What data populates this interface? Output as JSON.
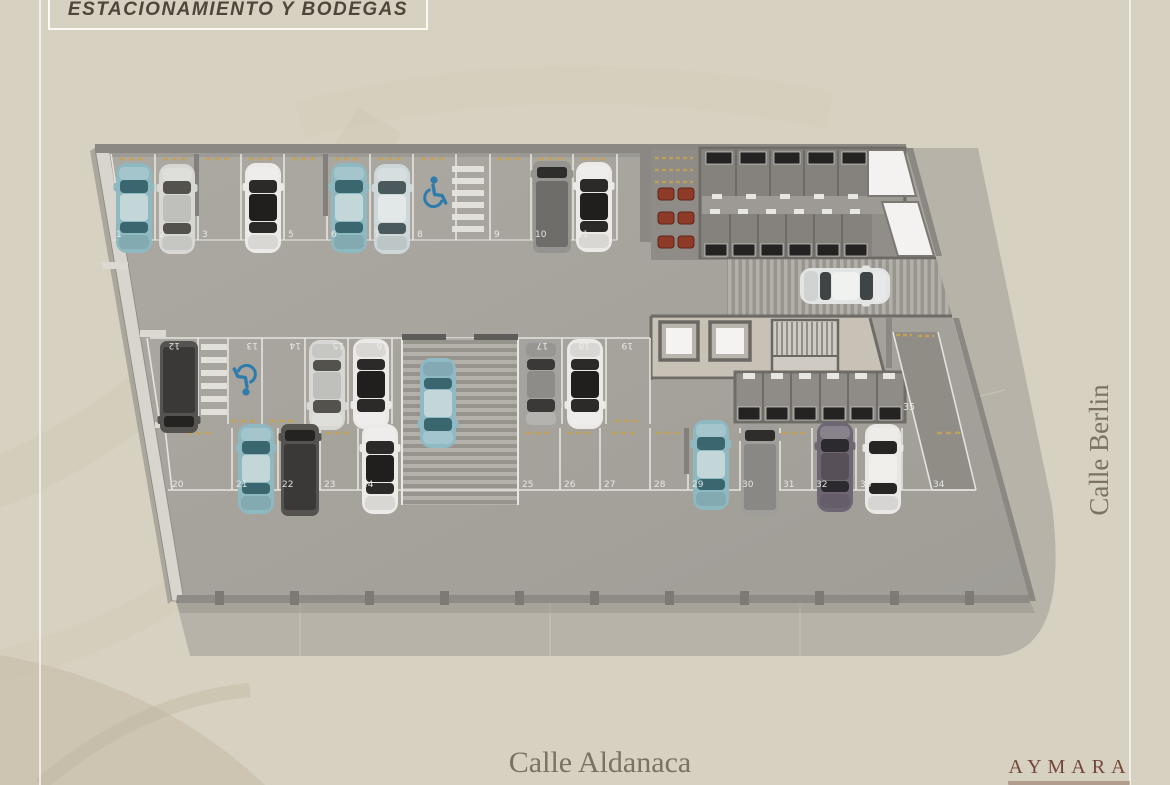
{
  "title": "ESTACIONAMIENTO Y BODEGAS",
  "streets": {
    "bottom": "Calle Aldanaca",
    "right": "Calle Berlin"
  },
  "brand": "AYMARA",
  "plan": {
    "top_row": [
      "1",
      "2",
      "3",
      "4",
      "5",
      "6",
      "7",
      "8",
      "9",
      "10",
      "11"
    ],
    "middle_row": [
      "12",
      "13",
      "14",
      "15",
      "16",
      "17",
      "18",
      "19"
    ],
    "bottom_row": [
      "20",
      "21",
      "22",
      "23",
      "24",
      "25",
      "26",
      "27",
      "28",
      "29",
      "30",
      "31",
      "32",
      "33",
      "34"
    ],
    "ramp_spot": "35",
    "accessible_spots": [
      "8",
      "13"
    ],
    "occupied_spots": [
      "1",
      "2",
      "4",
      "6",
      "7",
      "10",
      "11",
      "12",
      "15",
      "16",
      "17",
      "18",
      "21",
      "22",
      "24",
      "29",
      "30",
      "32",
      "33"
    ]
  },
  "colors": {
    "bg": "#d7d1c1",
    "slab": "#a7a39d",
    "sidewalk": "#b7b3a8",
    "wall": "#8b8883",
    "accent_blue": "#2e7cab",
    "spot_line": "#e9e7e2",
    "title_text": "#4e463a",
    "street_text": "#7b7164",
    "brand_text": "#72463a",
    "wheel_stop": "#c2a254",
    "moto_red": "#8d3a28"
  }
}
